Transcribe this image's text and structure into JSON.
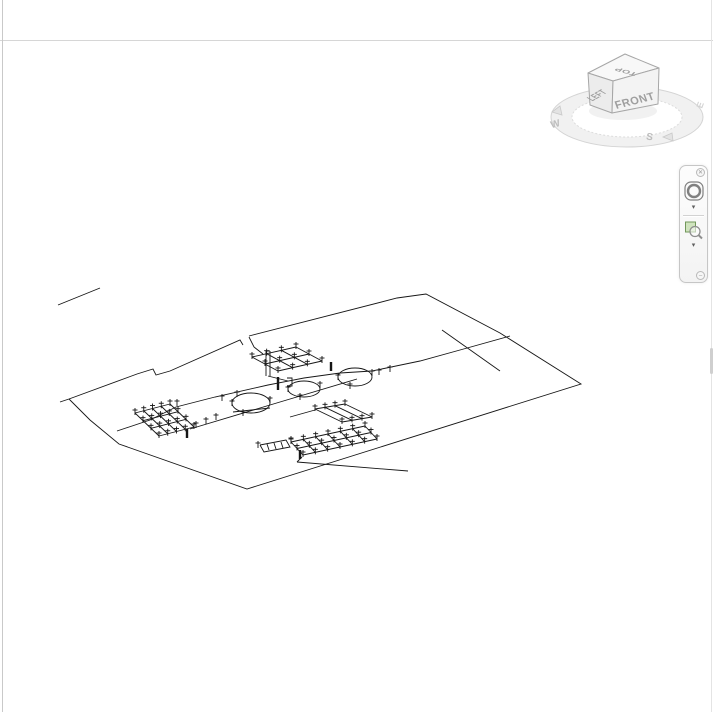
{
  "viewcube": {
    "top_label": "TOP",
    "left_label": "LEFT",
    "front_label": "FRONT",
    "compass_west": "W",
    "compass_south": "S",
    "compass_east": "E",
    "face_color": "#f5f5f5",
    "edge_color": "#a6a6a6",
    "label_color": "#9e9e9e",
    "ring_color": "#d4d4d4"
  },
  "navbar": {
    "close_glyph": "✕",
    "caret_glyph": "▾",
    "options_glyph": "–",
    "zoom_icon_fill": "#cfe3bd",
    "zoom_icon_border": "#71975a"
  },
  "canvas": {
    "background": "#ffffff",
    "border_top_color": "#d6d6d6",
    "border_left_color": "#c9c9c9",
    "border_right_color": "#e4e4e4"
  },
  "drawing": {
    "stroke": "#161616",
    "paths": [
      [
        [
          60,
          402
        ],
        [
          69,
          399
        ],
        [
          137,
          374
        ],
        [
          153,
          369
        ],
        [
          156,
          375
        ],
        [
          170,
          371
        ],
        [
          240,
          340
        ],
        [
          243,
          345
        ]
      ],
      [
        [
          249,
          336
        ],
        [
          397,
          298
        ],
        [
          426,
          294
        ],
        [
          500,
          333
        ],
        [
          581,
          384
        ],
        [
          247,
          489
        ],
        [
          119,
          444
        ],
        [
          90,
          420
        ],
        [
          69,
          399
        ]
      ],
      [
        [
          58,
          305
        ],
        [
          100,
          288
        ]
      ],
      [
        [
          117,
          431
        ],
        [
          150,
          420
        ],
        [
          176,
          407
        ],
        [
          215,
          397
        ],
        [
          268,
          385
        ],
        [
          304,
          378
        ],
        [
          340,
          373
        ],
        [
          372,
          371
        ],
        [
          420,
          361
        ],
        [
          460,
          350
        ],
        [
          510,
          336
        ]
      ],
      [
        [
          190,
          429
        ],
        [
          280,
          402
        ],
        [
          357,
          379
        ]
      ],
      [
        [
          442,
          330
        ],
        [
          500,
          371
        ]
      ],
      [
        [
          249,
          337
        ],
        [
          254,
          347
        ],
        [
          263,
          354
        ]
      ],
      [
        [
          297,
          462
        ],
        [
          408,
          471
        ]
      ],
      [
        [
          302,
          457
        ],
        [
          297,
          462
        ]
      ],
      [
        [
          266,
          351
        ],
        [
          266,
          376
        ]
      ],
      [
        [
          270,
          351
        ],
        [
          270,
          376
        ]
      ],
      [
        [
          266,
          351
        ],
        [
          270,
          351
        ]
      ],
      [
        [
          287,
          378
        ],
        [
          292,
          378
        ],
        [
          292,
          386
        ],
        [
          287,
          386
        ]
      ],
      [
        [
          260,
          445
        ],
        [
          286,
          440
        ],
        [
          290,
          447
        ],
        [
          264,
          452
        ],
        [
          260,
          445
        ]
      ],
      [
        [
          267,
          444
        ],
        [
          269,
          450
        ]
      ],
      [
        [
          274,
          443
        ],
        [
          276,
          449
        ]
      ],
      [
        [
          281,
          442
        ],
        [
          283,
          448
        ]
      ],
      [
        [
          290,
          417
        ],
        [
          315,
          410
        ]
      ],
      [
        [
          268,
          376
        ],
        [
          288,
          381
        ]
      ],
      [
        [
          233,
          412
        ],
        [
          270,
          408
        ]
      ]
    ],
    "structures": [
      {
        "o": [
          252,
          357
        ],
        "u": [
          44,
          -10
        ],
        "v": [
          26,
          14
        ],
        "nu": 4,
        "nv": 3
      },
      {
        "o": [
          135,
          413
        ],
        "u": [
          35,
          -9
        ],
        "v": [
          24,
          23
        ],
        "nu": 5,
        "nv": 4
      },
      {
        "o": [
          315,
          409
        ],
        "u": [
          30,
          -5
        ],
        "v": [
          27,
          13
        ],
        "nu": 4,
        "nv": 2
      },
      {
        "o": [
          291,
          442
        ],
        "u": [
          74,
          -16
        ],
        "v": [
          12,
          13
        ],
        "nu": 7,
        "nv": 3
      }
    ],
    "tanks": [
      {
        "cx": 251,
        "cy": 403,
        "rx": 19,
        "ry": 10
      },
      {
        "cx": 304,
        "cy": 389,
        "rx": 16,
        "ry": 8
      },
      {
        "cx": 355,
        "cy": 377,
        "rx": 17,
        "ry": 9
      }
    ],
    "ticks": [
      [
        232,
        404
      ],
      [
        270,
        401
      ],
      [
        243,
        414
      ],
      [
        288,
        390
      ],
      [
        320,
        386
      ],
      [
        300,
        398
      ],
      [
        338,
        378
      ],
      [
        372,
        374
      ],
      [
        350,
        387
      ],
      [
        222,
        399
      ],
      [
        237,
        395
      ],
      [
        177,
        404
      ],
      [
        196,
        426
      ],
      [
        206,
        422
      ],
      [
        216,
        418
      ],
      [
        379,
        373
      ],
      [
        390,
        370
      ],
      [
        258,
        446
      ],
      [
        291,
        441
      ]
    ],
    "bold": [
      [
        278,
        377,
        278,
        390
      ],
      [
        331,
        362,
        331,
        371
      ],
      [
        300,
        450,
        300,
        459
      ],
      [
        187,
        429,
        187,
        438
      ]
    ]
  }
}
